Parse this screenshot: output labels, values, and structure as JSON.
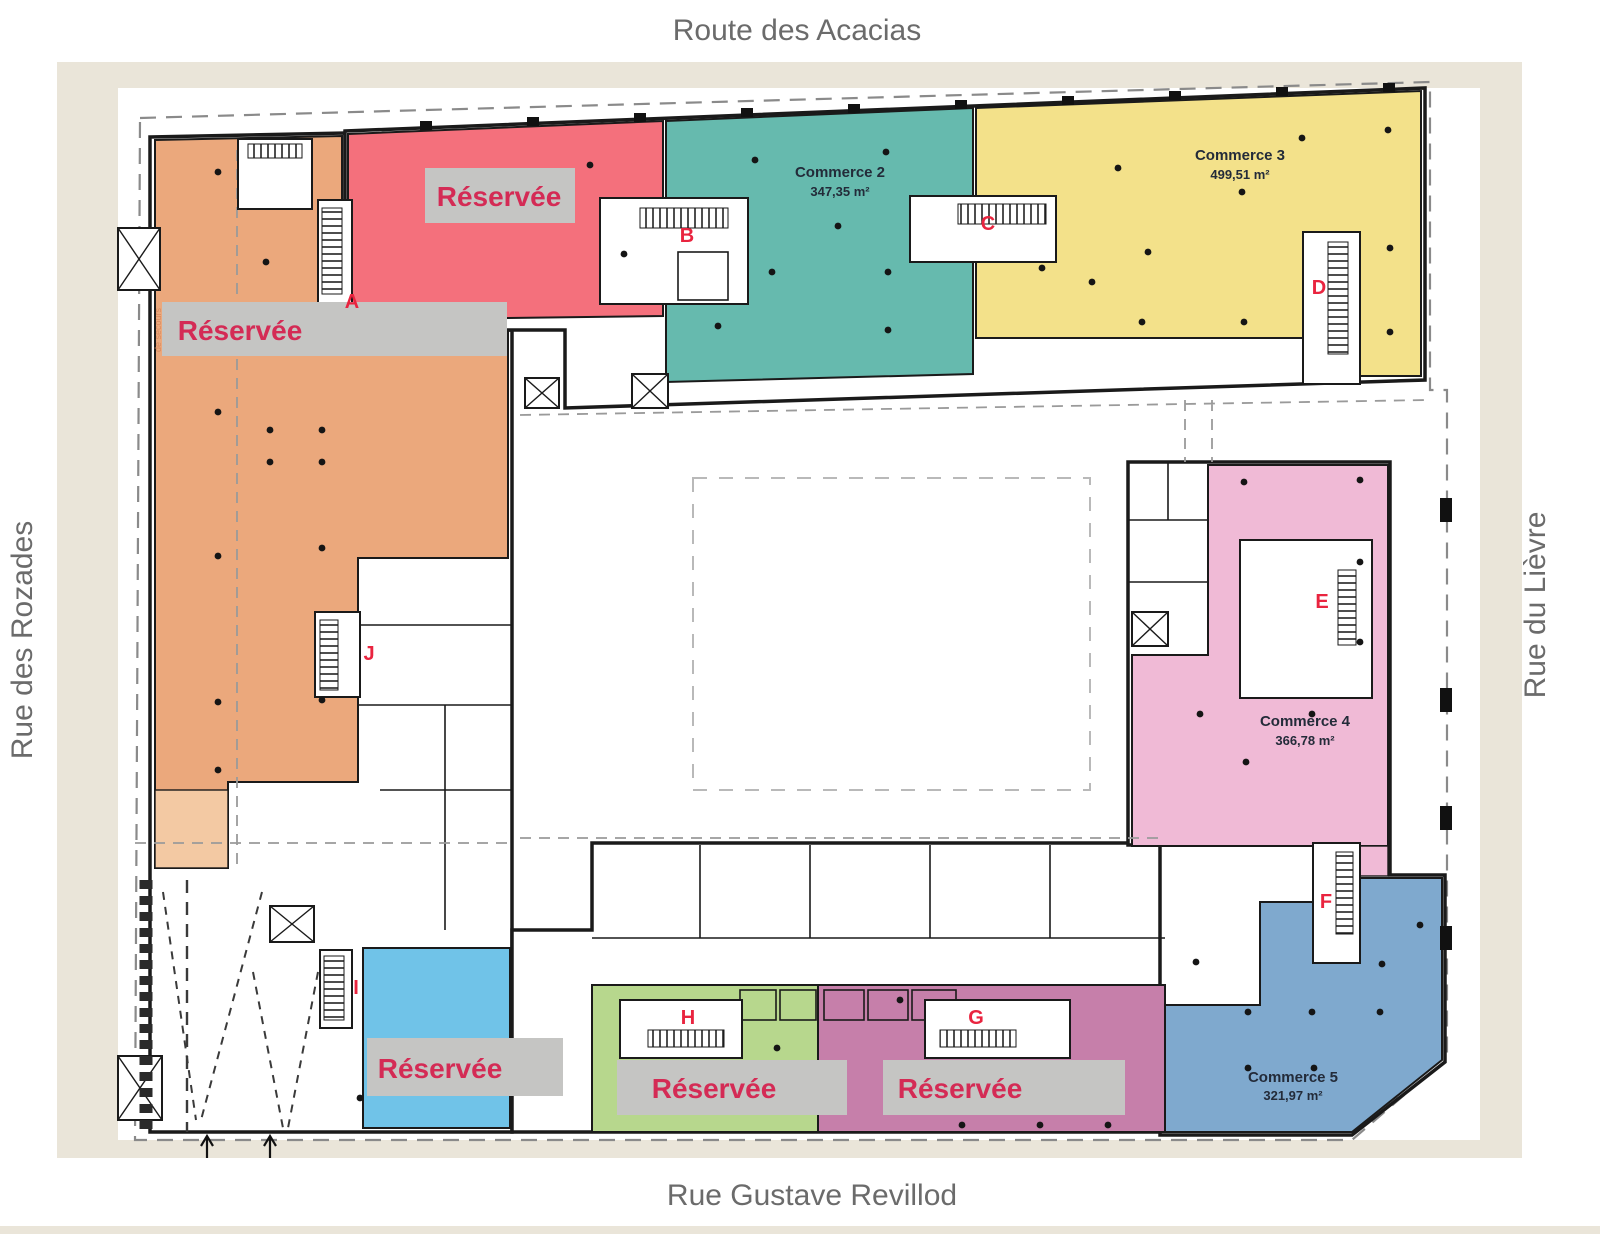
{
  "streets": {
    "top": "Route des Acacias",
    "left": "Rue des Rozades",
    "right": "Rue du Lièvre",
    "bottom": "Rue Gustave Revillod"
  },
  "zones": {
    "reserved_left": {
      "label": "Réservée",
      "color": "#EBA87C"
    },
    "reserved_top": {
      "label": "Réservée",
      "color": "#F4707C"
    },
    "commerce2": {
      "name": "Commerce 2",
      "area": "347,35 m²",
      "color": "#66BAAE"
    },
    "commerce3": {
      "name": "Commerce 3",
      "area": "499,51 m²",
      "color": "#F3E18A"
    },
    "commerce4": {
      "name": "Commerce 4",
      "area": "366,78 m²",
      "color": "#F0BAD6"
    },
    "commerce5": {
      "name": "Commerce 5",
      "area": "321,97 m²",
      "color": "#7FA9CE"
    },
    "reserved_lightblue": {
      "label": "Réservée",
      "color": "#70C3E8"
    },
    "reserved_green": {
      "label": "Réservée",
      "color": "#B7D78D"
    },
    "reserved_magenta": {
      "label": "Réservée",
      "color": "#C67FAA"
    }
  },
  "stair_letters": [
    "A",
    "B",
    "C",
    "D",
    "E",
    "F",
    "G",
    "H",
    "I",
    "J"
  ],
  "annotations": {
    "emergency_exit": "de secours"
  },
  "colors": {
    "band": "#C5C5C3",
    "reserved_text": "#D42B55",
    "letter": "#E9243F",
    "street_text": "#6B6B6B",
    "commerce_text": "#232B39",
    "wall": "#1A1A1A",
    "frame": "#EAE5D9",
    "orange_light": "#F3C9A3",
    "site_dash": "#8A8A8A"
  }
}
